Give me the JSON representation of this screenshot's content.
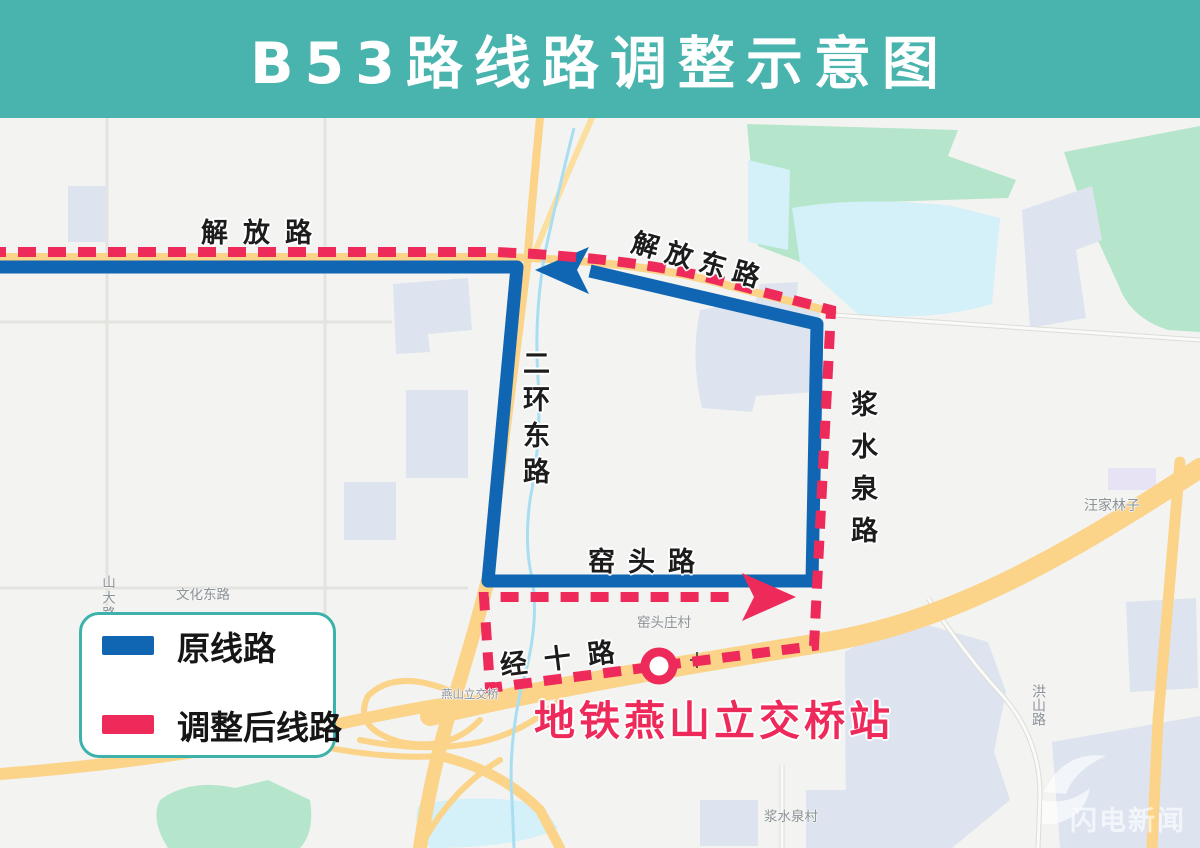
{
  "header": {
    "title": "B53路线路调整示意图"
  },
  "legend": {
    "items": [
      {
        "label": "原线路",
        "color": "#1066b2",
        "style": "solid"
      },
      {
        "label": "调整后线路",
        "color": "#ee2a5b",
        "style": "dashed"
      }
    ]
  },
  "map": {
    "road_labels": {
      "jiefang": "解放路",
      "jiefangdong": "解放东路",
      "erhuandong": "二环东路",
      "jiangshuiquan": "浆水泉路",
      "yaotou": "窑头路",
      "jingshi": "经十路"
    },
    "area_labels": {
      "shanda": "山大路",
      "wenhuadong": "文化东路",
      "wangjialinzi": "汪家林子",
      "hongshan": "洪山路",
      "yaotouzhuang": "窑头庄村",
      "jiangshuiquancun": "浆水泉村",
      "yanshan": "燕山立交桥"
    },
    "station": {
      "label": "地铁燕山立交桥站",
      "marker": "metro-circle"
    },
    "watermark": "闪电新闻"
  },
  "colors": {
    "header_bg": "#49b4ae",
    "original_route": "#1066b2",
    "adjusted_route": "#ee2a5b",
    "legend_border": "#3cb2aa",
    "station_text": "#ee2a5b",
    "map_background": "#f3f3f1",
    "park_green": "#b5e6cb",
    "water_blue": "#d4f0f8",
    "road_yellow": "#fbd389",
    "building_gray": "#dde4f0"
  }
}
